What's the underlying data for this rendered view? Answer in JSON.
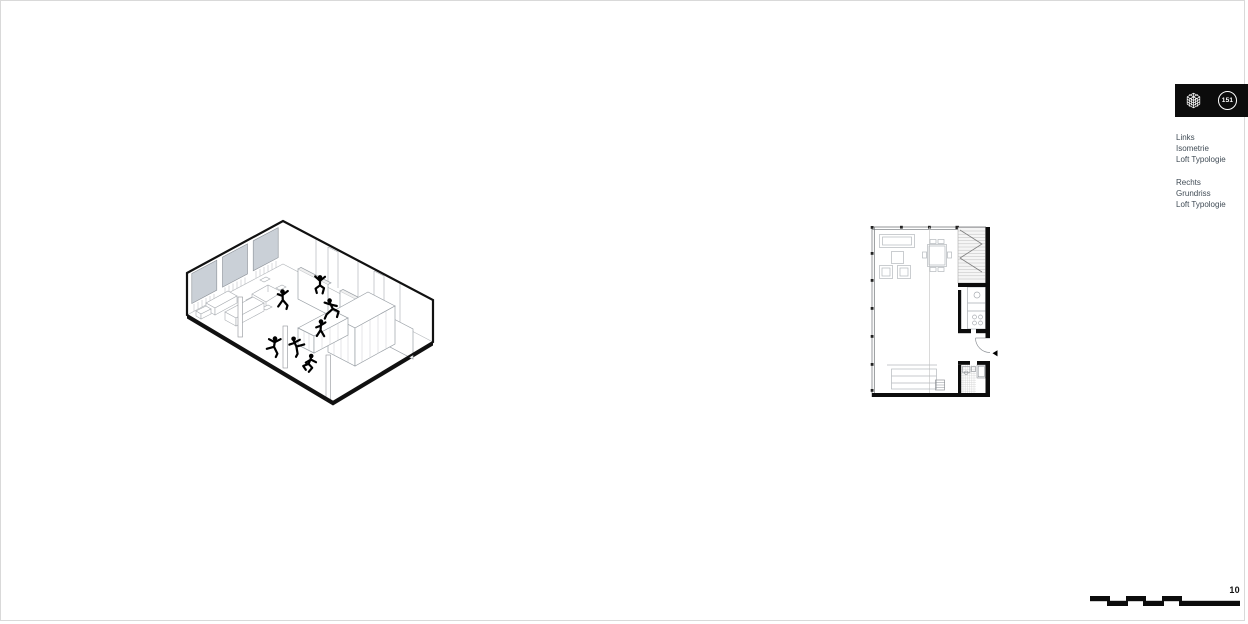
{
  "header": {
    "badge": "151",
    "icon": "isometric-cube",
    "bar_color": "#0c0c0c"
  },
  "captions": {
    "left": [
      "Links",
      "Isometrie",
      "Loft Typologie"
    ],
    "right": [
      "Rechts",
      "Grundriss",
      "Loft Typologie"
    ]
  },
  "footer": {
    "page_number": "10"
  },
  "figures": {
    "isometric": {
      "people_count": 7
    },
    "floorplan": {
      "rooms": [
        "living",
        "kitchen",
        "bath",
        "stair",
        "sleeping"
      ]
    }
  },
  "colors": {
    "caption_text": "#414c56",
    "accent_black": "#0c0c0c",
    "window_glass": "#cad0d7",
    "line_gray": "#a9adb2"
  }
}
